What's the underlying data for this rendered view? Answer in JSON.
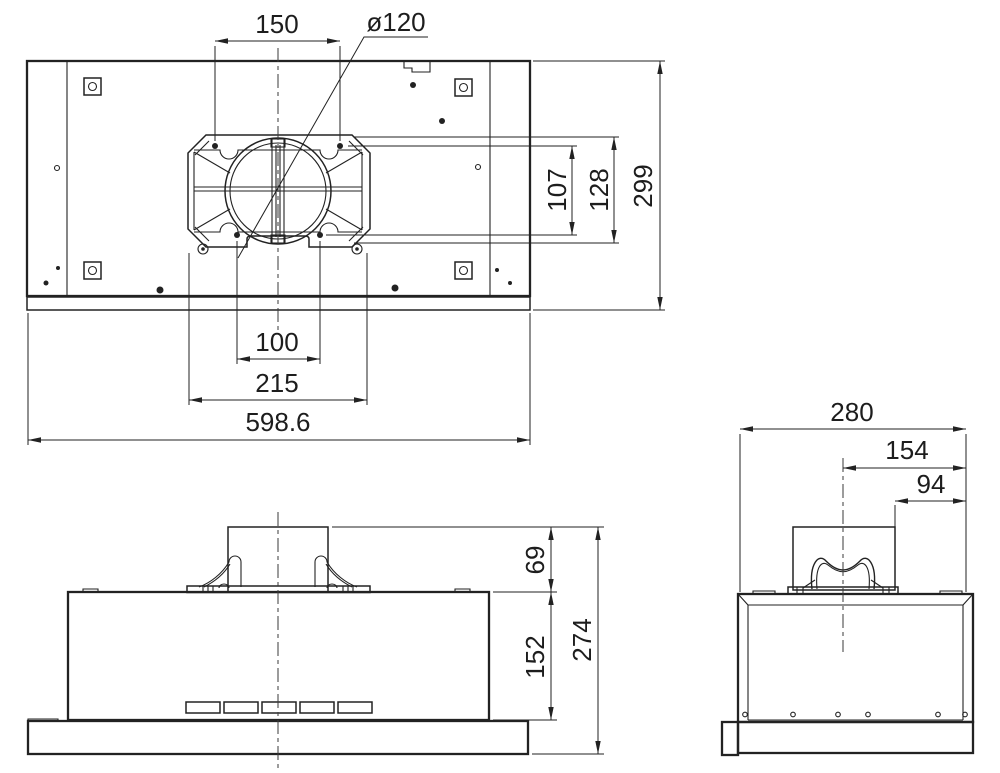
{
  "colors": {
    "line": "#222222",
    "background": "#ffffff"
  },
  "top_view": {
    "dims": {
      "hole_spacing_150": "150",
      "duct_diameter": "ø120",
      "offset_107": "107",
      "offset_128": "128",
      "depth_299": "299",
      "hole_spacing_100": "100",
      "plate_width_215": "215",
      "total_width_598_6": "598.6"
    }
  },
  "front_view": {
    "dims": {
      "duct_height_69": "69",
      "body_height_152": "152",
      "total_height_274": "274"
    }
  },
  "side_view": {
    "dims": {
      "total_depth_280": "280",
      "center_to_back_154": "154",
      "duct_to_back_94": "94"
    }
  }
}
